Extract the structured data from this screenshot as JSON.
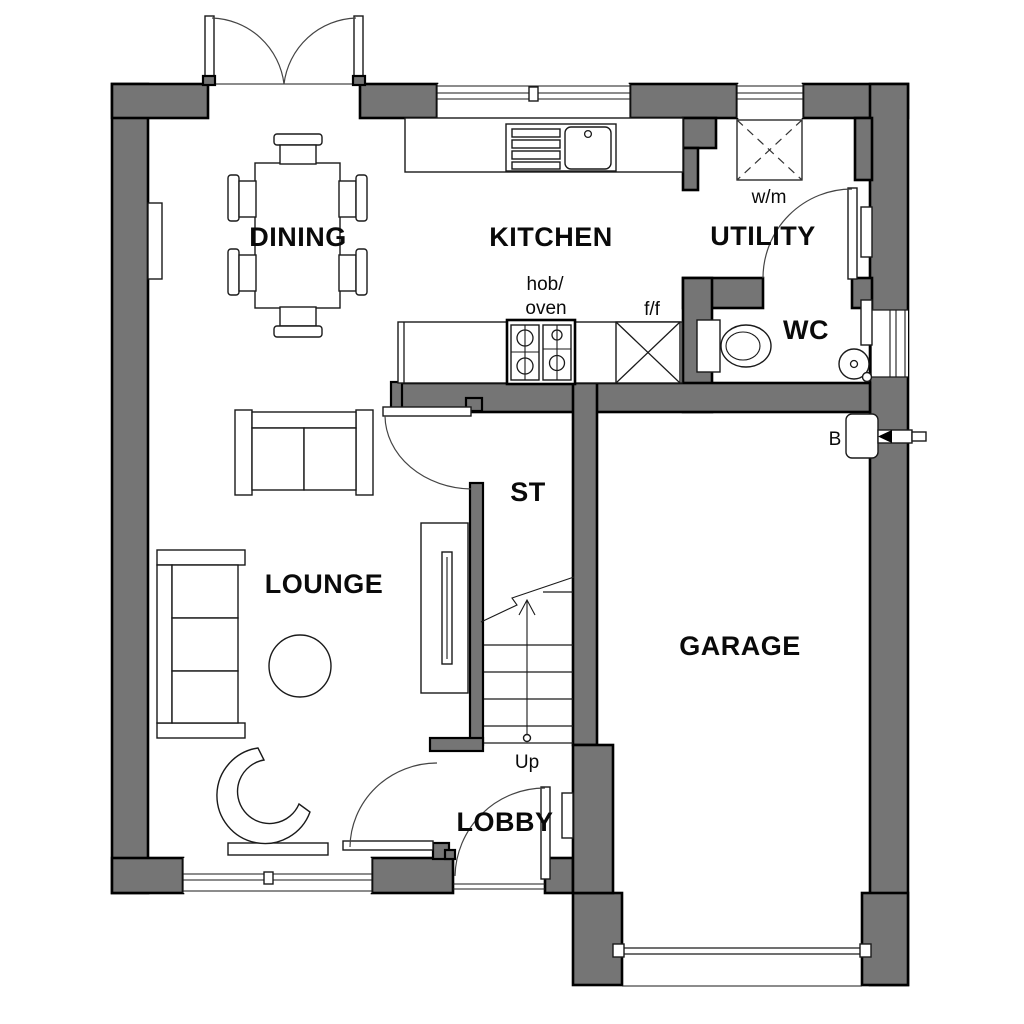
{
  "plan": {
    "title": "Ground floor plan",
    "rooms": [
      {
        "label": "DINING"
      },
      {
        "label": "KITCHEN"
      },
      {
        "label": "UTILITY"
      },
      {
        "label": "WC"
      },
      {
        "label": "ST"
      },
      {
        "label": "LOUNGE"
      },
      {
        "label": "GARAGE"
      },
      {
        "label": "LOBBY"
      }
    ],
    "annotations": [
      {
        "label": "w/m"
      },
      {
        "label": "hob/"
      },
      {
        "label": "oven"
      },
      {
        "label": "f/f"
      },
      {
        "label": "Up"
      },
      {
        "label": "B"
      }
    ]
  },
  "colors": {
    "wall_fill": "#757575",
    "wall_outline": "#000000",
    "fixture_line": "#1a1a1a",
    "label_text": "#0a0a0a",
    "background": "#ffffff"
  }
}
